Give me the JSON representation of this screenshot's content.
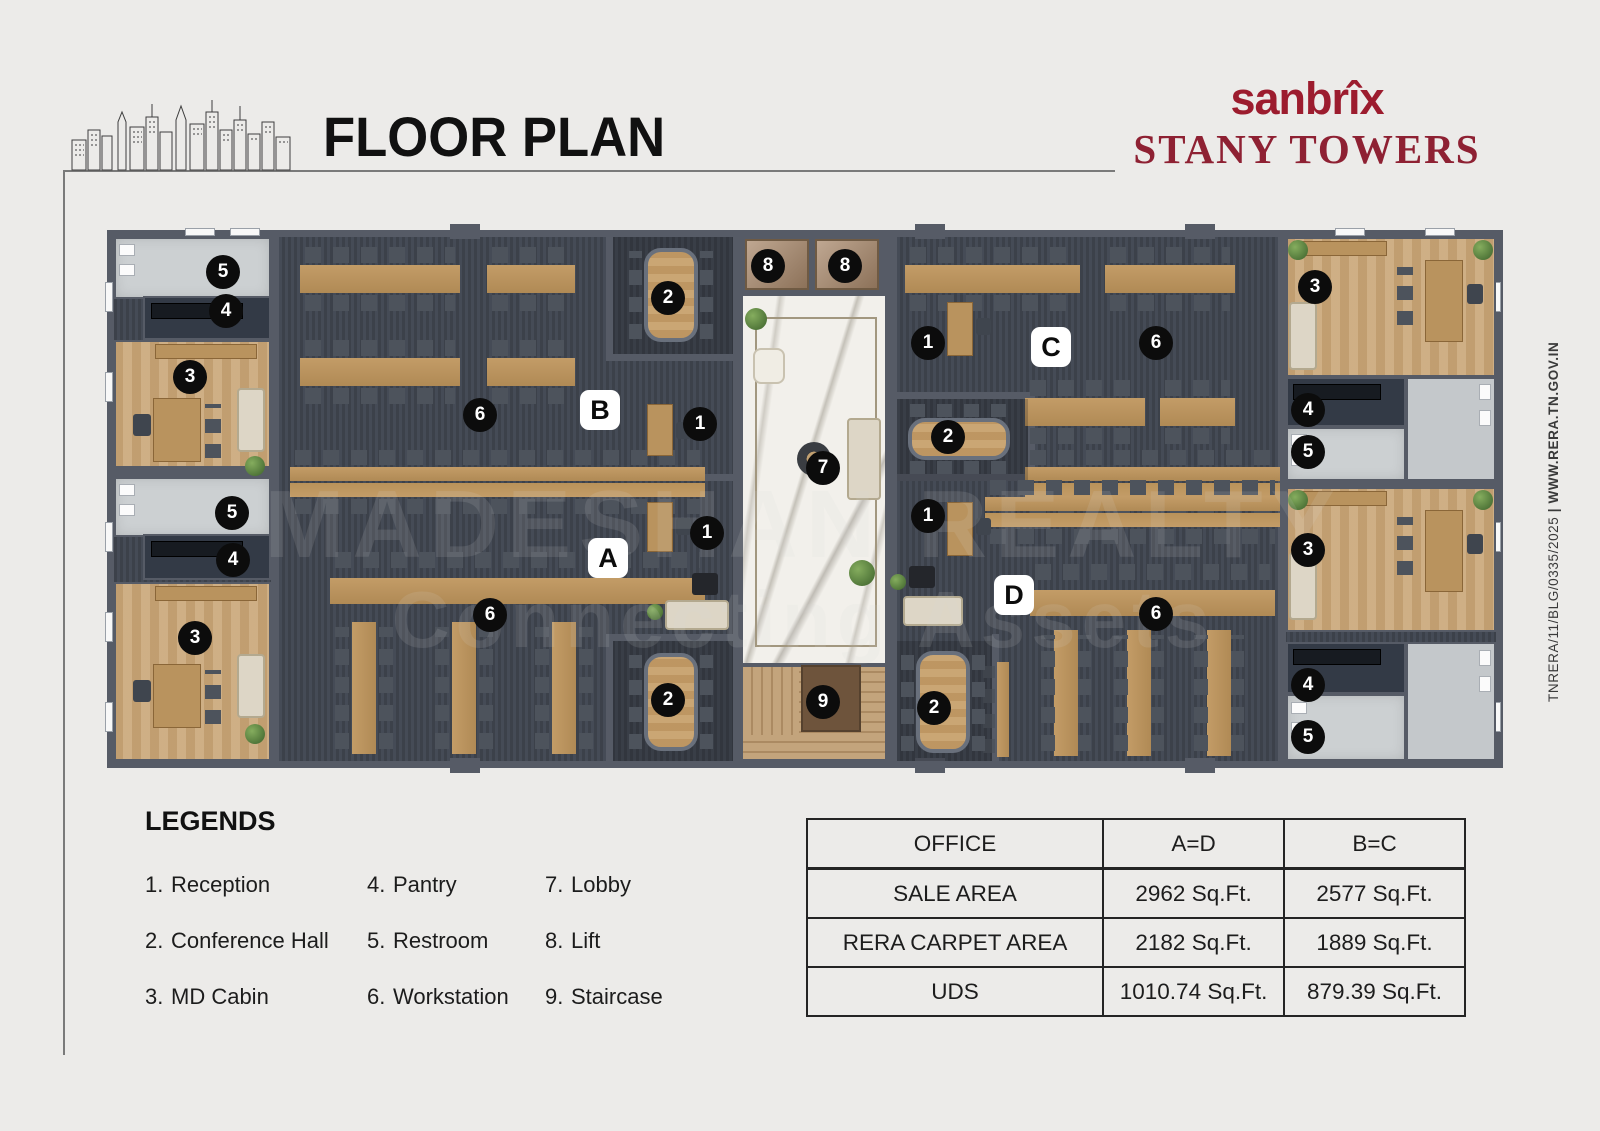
{
  "header": {
    "title": "FLOOR PLAN",
    "brand_light": "san",
    "brand_bold": "brîx",
    "brand_sub": "STANY TOWERS"
  },
  "side_note": {
    "rera_number": "TNRERA/11/BLG/0335/2025",
    "separator": " | ",
    "website": "WWW.RERA.TN.GOV.IN"
  },
  "watermark": {
    "line1": "MADESHAN REALTY",
    "line2": "Connecting Assets"
  },
  "legends": {
    "heading": "LEGENDS",
    "items": [
      {
        "num": "1.",
        "label": "Reception"
      },
      {
        "num": "2.",
        "label": "Conference Hall"
      },
      {
        "num": "3.",
        "label": "MD Cabin"
      },
      {
        "num": "4.",
        "label": "Pantry"
      },
      {
        "num": "5.",
        "label": "Restroom"
      },
      {
        "num": "6.",
        "label": "Workstation"
      },
      {
        "num": "7.",
        "label": "Lobby"
      },
      {
        "num": "8.",
        "label": "Lift"
      },
      {
        "num": "9.",
        "label": "Staircase"
      }
    ]
  },
  "area_table": {
    "headers": [
      "OFFICE",
      "A=D",
      "B=C"
    ],
    "rows": [
      [
        "SALE AREA",
        "2962 Sq.Ft.",
        "2577 Sq.Ft."
      ],
      [
        "RERA CARPET AREA",
        "2182 Sq.Ft.",
        "1889 Sq.Ft."
      ],
      [
        "UDS",
        "1010.74 Sq.Ft.",
        "879.39 Sq.Ft."
      ]
    ]
  },
  "plan": {
    "office_labels": [
      "A",
      "B",
      "C",
      "D"
    ],
    "markers": [
      {
        "label": "5"
      },
      {
        "label": "4"
      },
      {
        "label": "3"
      },
      {
        "label": "2"
      },
      {
        "label": "6"
      },
      {
        "label": "B"
      },
      {
        "label": "1"
      },
      {
        "label": "8"
      },
      {
        "label": "8"
      },
      {
        "label": "7"
      },
      {
        "label": "9"
      },
      {
        "label": "5"
      },
      {
        "label": "4"
      },
      {
        "label": "3"
      },
      {
        "label": "A"
      },
      {
        "label": "1"
      },
      {
        "label": "6"
      },
      {
        "label": "2"
      },
      {
        "label": "1"
      },
      {
        "label": "C"
      },
      {
        "label": "6"
      },
      {
        "label": "2"
      },
      {
        "label": "3"
      },
      {
        "label": "4"
      },
      {
        "label": "5"
      },
      {
        "label": "1"
      },
      {
        "label": "D"
      },
      {
        "label": "6"
      },
      {
        "label": "2"
      },
      {
        "label": "3"
      },
      {
        "label": "4"
      },
      {
        "label": "5"
      }
    ]
  },
  "colors": {
    "accent_red": "#9c1c2e",
    "wall": "#565b66",
    "carpet": "#3f444e",
    "desk_wood": "#c39c67",
    "cabin_wood": "#cba97c",
    "marble": "#f2f0eb",
    "page_bg": "#ecebe9"
  }
}
